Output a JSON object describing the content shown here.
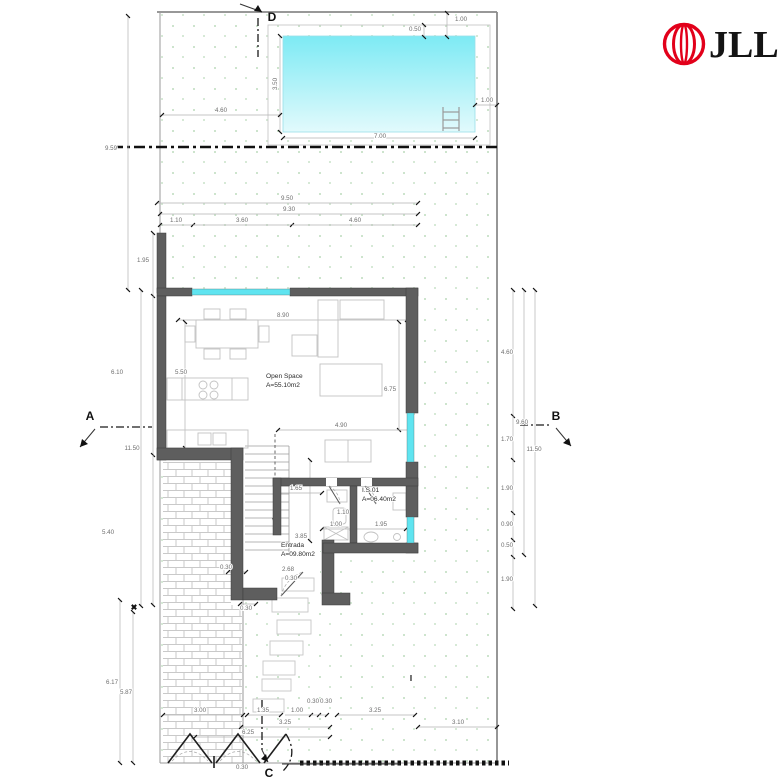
{
  "brand": {
    "name": "JLL",
    "logo_red": "#E2001A"
  },
  "drawing": {
    "colors": {
      "pool_top": "#7deaf4",
      "pool_bottom": "#e2fafc",
      "window": "#5fe4f0",
      "wall": "#5e5e5e"
    },
    "rooms": [
      {
        "label": "Open Space",
        "area": "A=55.10m2",
        "x": 266,
        "y": 378
      },
      {
        "label": "I.S.01",
        "area": "A=06.40m2",
        "x": 362,
        "y": 492
      },
      {
        "label": "Entrada",
        "area": "A=09.80m2",
        "x": 281,
        "y": 547
      }
    ],
    "section_markers": [
      {
        "t": "D",
        "x": 272,
        "y": 21
      },
      {
        "t": "A",
        "x": 90,
        "y": 420
      },
      {
        "t": "B",
        "x": 556,
        "y": 420
      },
      {
        "t": "C",
        "x": 269,
        "y": 777
      }
    ],
    "annotations": [
      {
        "t": "I",
        "x": 411,
        "y": 681
      },
      {
        "t": "✖",
        "x": 134,
        "y": 610
      }
    ],
    "dimensions": [
      {
        "t": "9.50",
        "x": 287,
        "y": 200
      },
      {
        "t": "9.30",
        "x": 289,
        "y": 211
      },
      {
        "t": "1.10",
        "x": 176,
        "y": 222
      },
      {
        "t": "3.60",
        "x": 242,
        "y": 222
      },
      {
        "t": "4.60",
        "x": 355,
        "y": 222
      },
      {
        "t": "3.50",
        "x": 277,
        "y": 84,
        "r": -90
      },
      {
        "t": "4.60",
        "x": 221,
        "y": 112
      },
      {
        "t": "7.00",
        "x": 380,
        "y": 138
      },
      {
        "t": "1.00",
        "x": 487,
        "y": 102
      },
      {
        "t": "0.50",
        "x": 415,
        "y": 31
      },
      {
        "t": "1.00",
        "x": 461,
        "y": 21
      },
      {
        "t": "9.59",
        "x": 111,
        "y": 150
      },
      {
        "t": "1.95",
        "x": 143,
        "y": 262
      },
      {
        "t": "6.10",
        "x": 117,
        "y": 374
      },
      {
        "t": "11.50",
        "x": 132,
        "y": 450
      },
      {
        "t": "5.40",
        "x": 108,
        "y": 534
      },
      {
        "t": "6.17",
        "x": 112,
        "y": 684
      },
      {
        "t": "5.87",
        "x": 126,
        "y": 694
      },
      {
        "t": "4.60",
        "x": 507,
        "y": 354
      },
      {
        "t": "9.60",
        "x": 522,
        "y": 424
      },
      {
        "t": "1.70",
        "x": 507,
        "y": 441
      },
      {
        "t": "11.50",
        "x": 534,
        "y": 451
      },
      {
        "t": "1.90",
        "x": 507,
        "y": 490
      },
      {
        "t": "0.90",
        "x": 507,
        "y": 526
      },
      {
        "t": "0.50",
        "x": 507,
        "y": 547
      },
      {
        "t": "1.90",
        "x": 507,
        "y": 581
      },
      {
        "t": "8.90",
        "x": 283,
        "y": 317
      },
      {
        "t": "5.50",
        "x": 181,
        "y": 374
      },
      {
        "t": "6.75",
        "x": 390,
        "y": 391
      },
      {
        "t": "4.90",
        "x": 341,
        "y": 427
      },
      {
        "t": "1.65",
        "x": 296,
        "y": 490
      },
      {
        "t": "3.85",
        "x": 301,
        "y": 538
      },
      {
        "t": "1.00",
        "x": 336,
        "y": 526
      },
      {
        "t": "1.95",
        "x": 381,
        "y": 526
      },
      {
        "t": "1.10",
        "x": 343,
        "y": 514
      },
      {
        "t": "2.68",
        "x": 288,
        "y": 571
      },
      {
        "t": "0.30",
        "x": 291,
        "y": 580
      },
      {
        "t": "0.30",
        "x": 226,
        "y": 569
      },
      {
        "t": "0.30",
        "x": 246,
        "y": 610
      },
      {
        "t": "3.00",
        "x": 200,
        "y": 712
      },
      {
        "t": "1.35",
        "x": 263,
        "y": 712
      },
      {
        "t": "1.00",
        "x": 297,
        "y": 712
      },
      {
        "t": "0.30",
        "x": 313,
        "y": 703
      },
      {
        "t": "0.30",
        "x": 326,
        "y": 703
      },
      {
        "t": "3.25",
        "x": 375,
        "y": 712
      },
      {
        "t": "3.25",
        "x": 285,
        "y": 724
      },
      {
        "t": "3.10",
        "x": 458,
        "y": 724
      },
      {
        "t": "6.25",
        "x": 248,
        "y": 734
      },
      {
        "t": "0.30",
        "x": 242,
        "y": 769
      }
    ]
  }
}
